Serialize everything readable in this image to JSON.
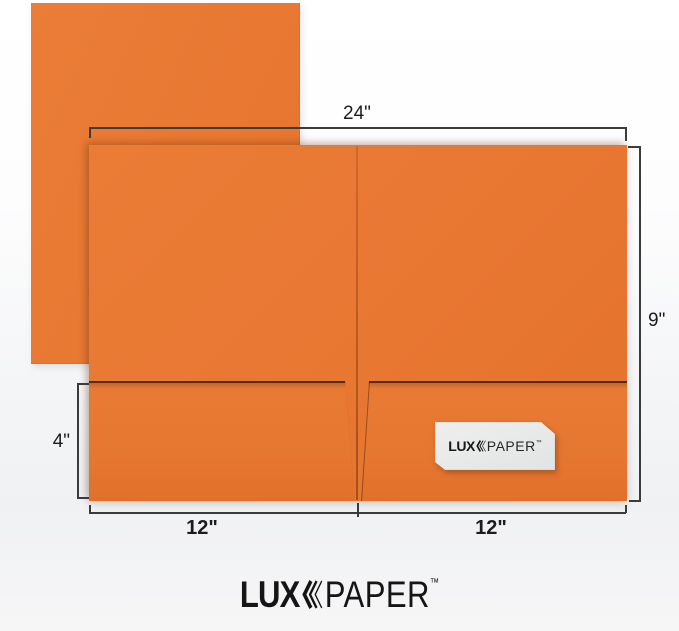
{
  "brand": {
    "lux": "LUX",
    "paper": "PAPER",
    "tm": "™"
  },
  "dimensions": {
    "width_label": "24\"",
    "height_label": "9\"",
    "pocket_depth_label": "4\"",
    "left_panel_label": "12\"",
    "right_panel_label": "12\""
  },
  "colors": {
    "folder_orange": "#E87732",
    "pocket_edge": "#2C1405",
    "dimension_line": "#3B3B3B",
    "card_background": "#E9EAEA",
    "logo_black": "#151515",
    "background_top": "#FFFFFF",
    "background_bottom": "#F6F6F7"
  }
}
